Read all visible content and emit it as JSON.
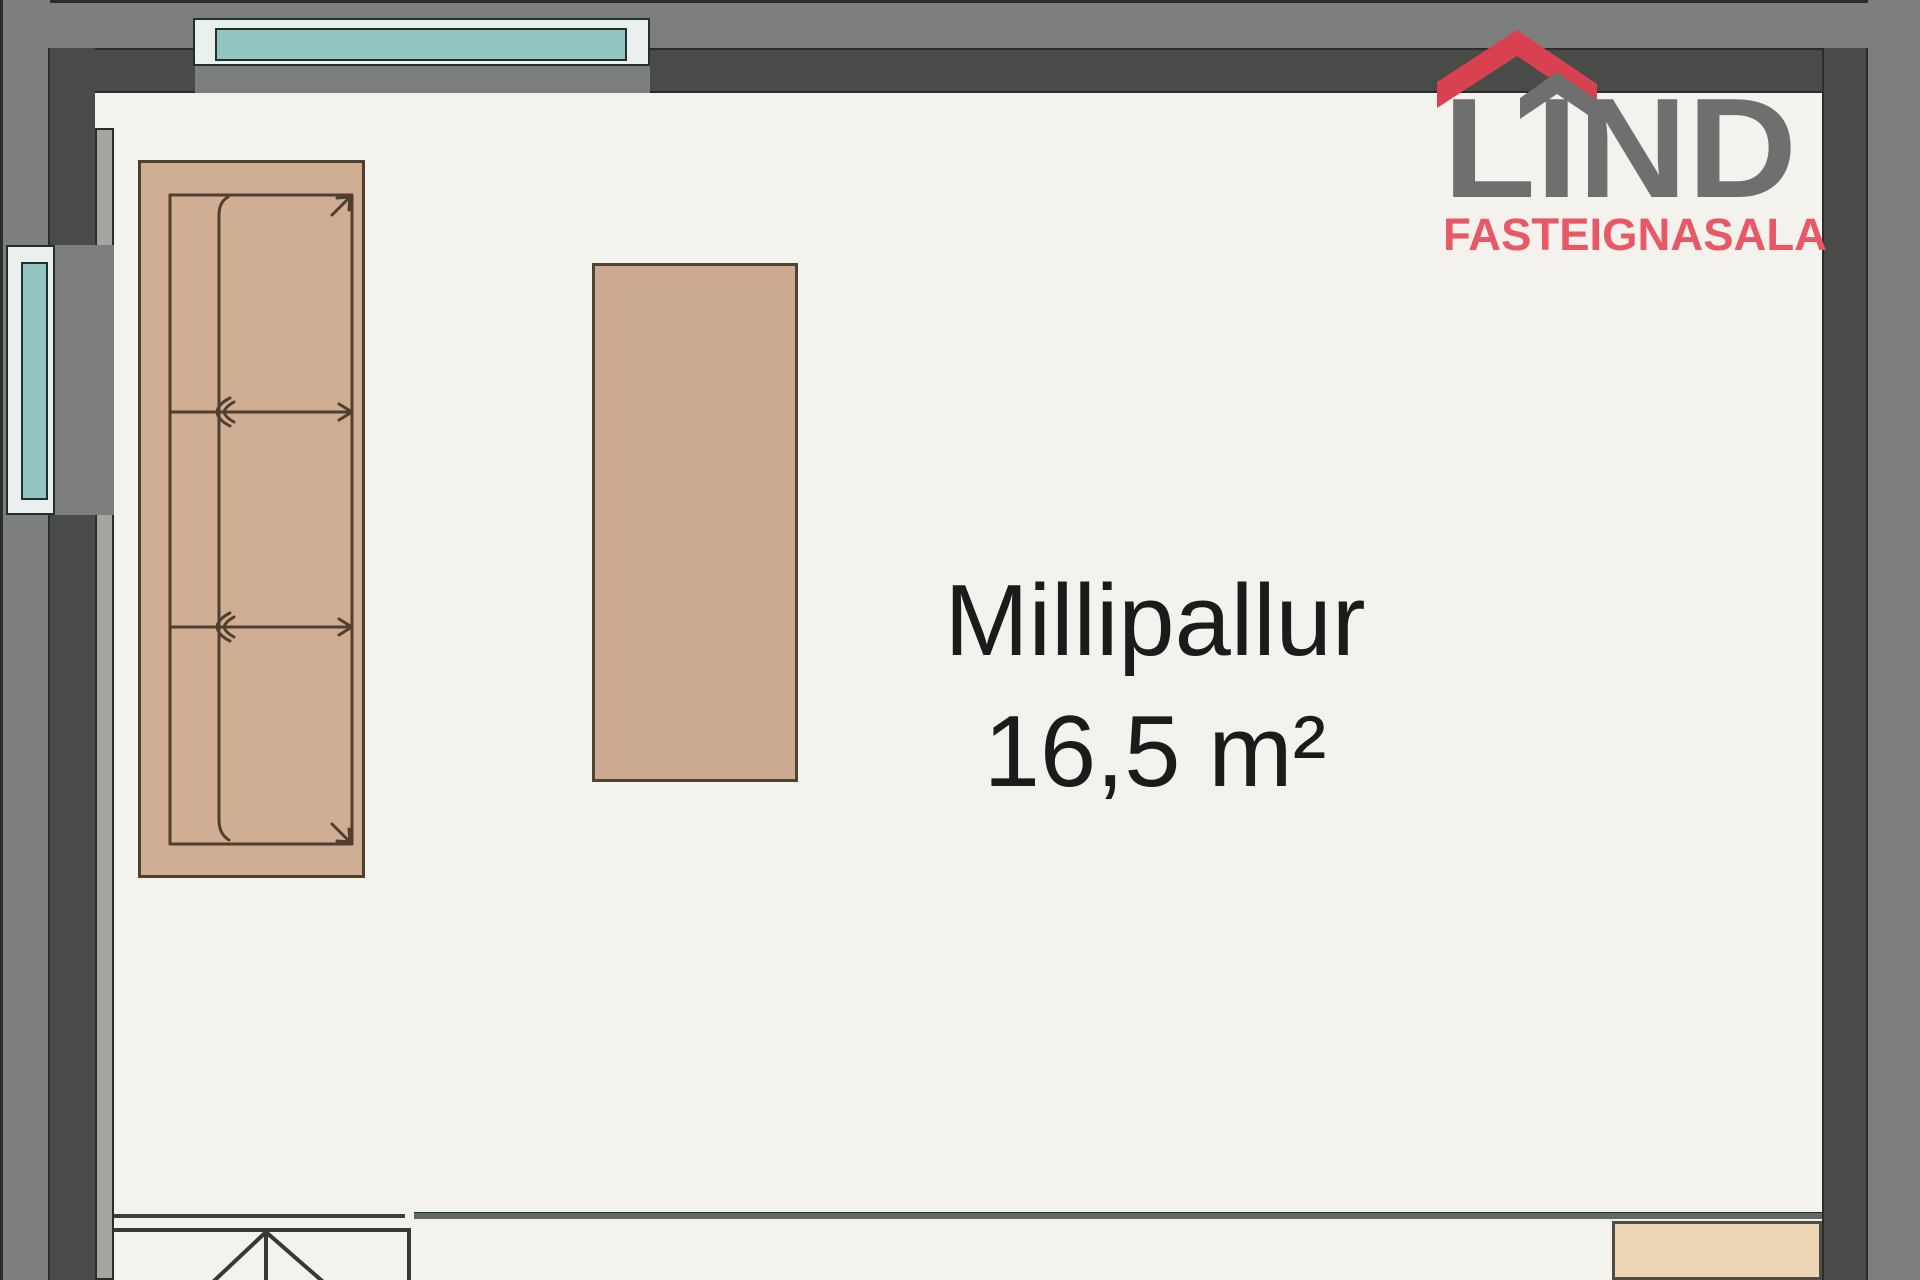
{
  "room": {
    "name": "Millipallur",
    "area": "16,5 m²"
  },
  "logo": {
    "title": "LIND",
    "subtitle": "FASTEIGNASALA"
  },
  "colors": {
    "floor": "#f4f2ec",
    "wall_outer": "#7c7f7b",
    "wall_inner": "#484b47",
    "wall_edge": "#2b2d2b",
    "wall_face_strip": "#a3a5a0",
    "window_frame": "#eaf0ed",
    "window_glass": "#93c6c3",
    "window_outline": "#203230",
    "sofa_fill": "#cfae94",
    "sofa_stroke": "#4e3f2f",
    "table_fill": "#cbaa90",
    "table_stroke": "#4e4434",
    "cabinet_fill": "#eed7b4",
    "cabinet_stroke": "#514c45",
    "railing_left": "#3c403c",
    "railing_right": "#5f6b63",
    "stair_line": "#363936",
    "label_text": "#1b1b1b",
    "logo_gray": "#6d706e",
    "logo_red": "#d8414f",
    "logo_sub_red": "#e85965"
  }
}
